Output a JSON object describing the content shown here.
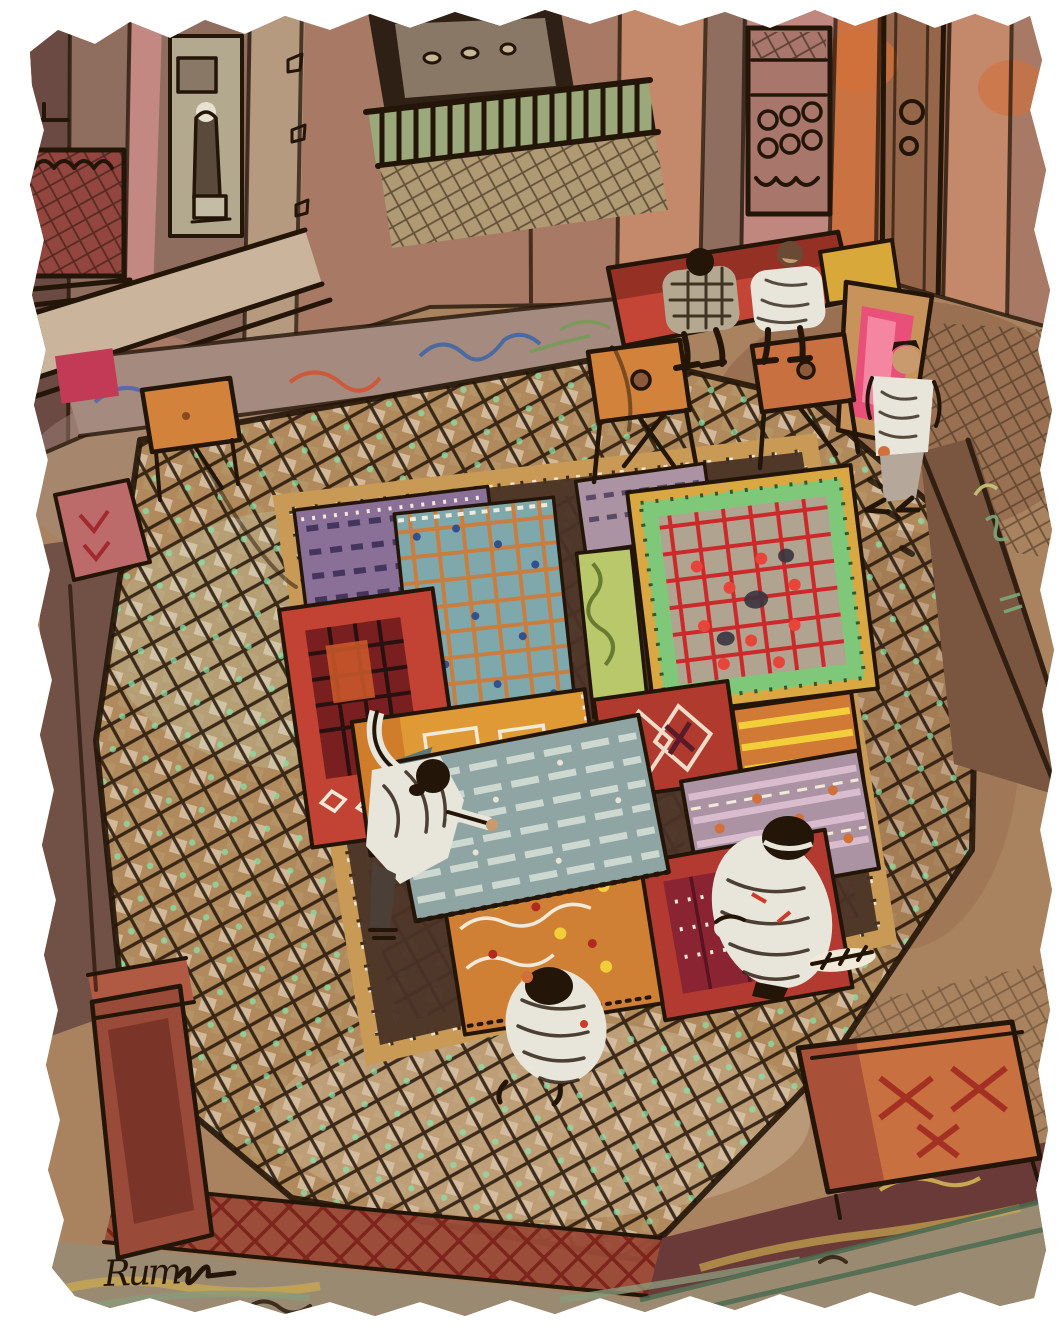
{
  "artwork": {
    "signature": "Rum",
    "description": "Watercolor and ink painting on torn-edge paper: overhead view of a carpet showroom. Robed figures unfold colorful rugs on a large diamond-lattice carpet; benches, low tables and carved doorways surround the room."
  },
  "palette": {
    "ink": "#241509",
    "wall_rose": "#a87a66",
    "wall_plum": "#6a4a42",
    "wall_mauve": "#8f6e60",
    "wall_pink": "#c48a84",
    "wall_salmon": "#c4886a",
    "wall_tan": "#b59a80",
    "wall_orange": "#d2703a",
    "door_pale": "#b3a98f",
    "door_brown": "#96664a",
    "alcove_dark": "#2e2015",
    "alcove_back": "#8a7866",
    "balustrade_green": "#9aa87a",
    "ledge_cream": "#cbb49c",
    "floor_tan": "#a9835f",
    "floor_brown": "#8a5f46",
    "floor_mauve": "#a58a80",
    "carpet_base": "#b08a5c",
    "carpet_cell_light": "#d9c4aa",
    "carpet_cell_dark": "#b89a6e",
    "carpet_gold": "#c99a55",
    "platform_dark": "#4a3326",
    "mint": "#8ae0a8",
    "dot_white": "#f2ead8",
    "rug_purple": "#8a6f96",
    "rug_teal": "#7fa8ad",
    "rug_orange_grid": "#d07a35",
    "rug_blue_dot": "#33508f",
    "rug_red": "#c24233",
    "rug_red_dark": "#8a2433",
    "rug_amber": "#e09a35",
    "rug_orange": "#d08035",
    "rug_yellow": "#f2cf3a",
    "rug_pink": "#ab93a3",
    "rug_bluegray": "#8fa5a4",
    "rug_stripe_pale": "#ccd8d0",
    "rug_green": "#b8c86a",
    "rug_border_gold": "#d9a843",
    "rug_mint_border": "#7fc87a",
    "grid_red": "#cc2a2a",
    "bench_red": "#c44536",
    "bench_red_dark": "#8a2a22",
    "bench_pink": "#e8507a",
    "bench_pink_light": "#f78fa8",
    "bench_orange": "#c87040",
    "bench_rust": "#9a4a38",
    "table_orange": "#d2823a",
    "robe_white": "#e8e5da",
    "robe_shadow": "#b8b5a8",
    "skin": "#c89a6e",
    "hair_brown": "#6a4a35",
    "fg_olive": "#9a8a72",
    "fg_yellow": "#c8a850",
    "fg_green": "#4a6a50",
    "maroon_band": "#6a3a38",
    "xhatch_red": "#7a2018"
  }
}
